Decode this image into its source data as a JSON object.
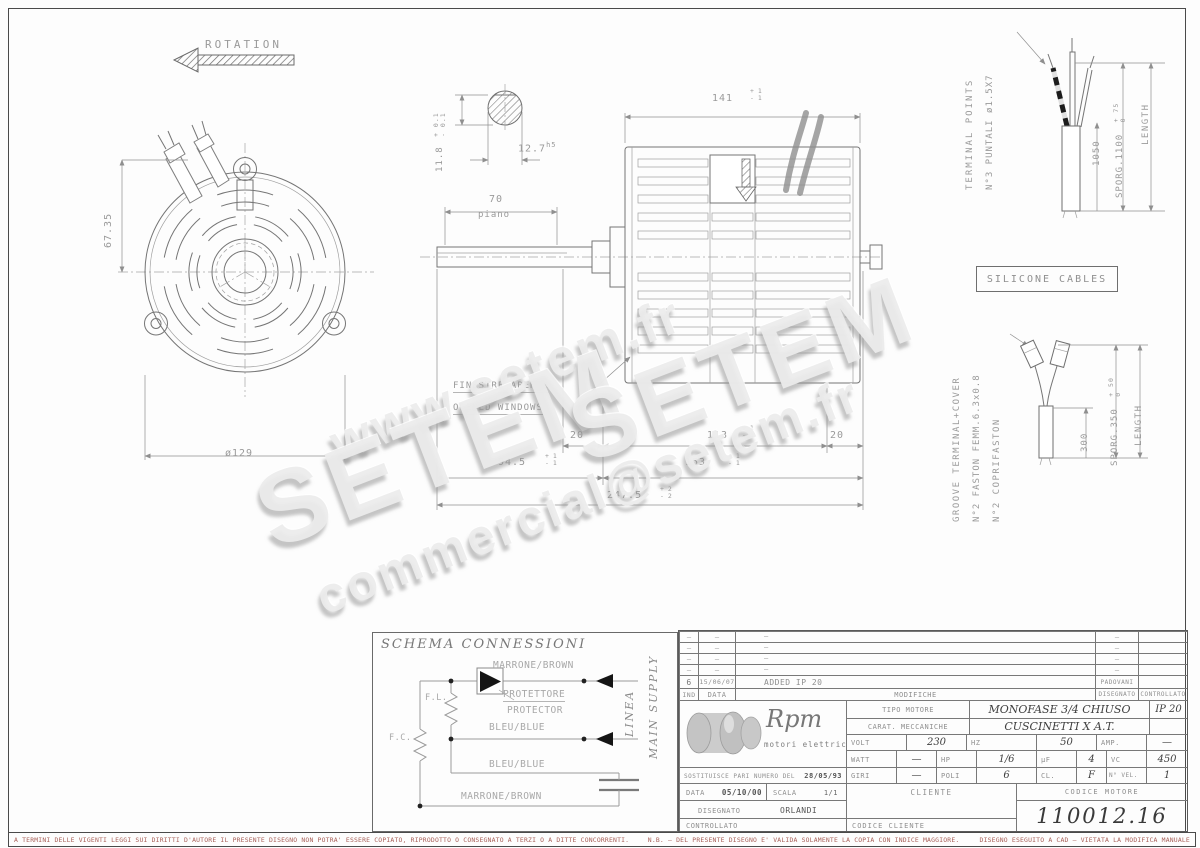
{
  "colors": {
    "disclaimer_red": "#a85f57",
    "cad_line": "#757575",
    "cad_text": "#9a9a9a"
  },
  "watermarks": {
    "w1": "www.setem.fr",
    "w2": "SETEM",
    "w3": "SETEM",
    "w4": "commercial@setem.fr"
  },
  "ann": {
    "rotation": "ROTATION",
    "dim_6735": "67.35",
    "dim_129": "ø129",
    "dim_118": "11.8",
    "tol_01p": "+ 0.1",
    "tol_01m": "- 0.1",
    "dim_127": "12.7",
    "dim_127_fit": "h5",
    "dim_70": "70",
    "piano": "piano",
    "dim_141": "141",
    "tol_1p": "+ 1",
    "tol_1m": "- 1",
    "finestre": "FINESTRE APERTE",
    "opened": "OPENED WINDOWS",
    "dim_20a": "20",
    "dim_113": "113",
    "tol113p": "+ 1",
    "tol113m": "- 1",
    "dim_20b": "20",
    "dim_945": "94.5",
    "tol945p": "+ 1",
    "tol945m": "- 1",
    "dim_153": "153",
    "tol153p": "+ 1",
    "tol153m": "- 1",
    "dim_2475": "247.5",
    "tol_2p": "+ 2",
    "tol_2m": "- 2",
    "terminal_points": "TERMINAL POINTS",
    "puntali": "N°3 PUNTALI ø1.5X7",
    "dim_1050": "1050",
    "sporg_1100": "SPORG.1100",
    "tol_75": "+ 75",
    "tol_0a": "0",
    "length_a": "LENGTH",
    "silicone": "SILICONE CABLES",
    "groove": "GROOVE TERMINAL+COVER",
    "faston": "N°2 FASTON FEMM.6.3x0.8",
    "coprifaston": "N°2 COPRIFASTON",
    "dim_300": "300",
    "sporg_350": "SPORG.350",
    "tol_50": "+ 50",
    "tol_0b": "0",
    "length_b": "LENGTH"
  },
  "schema": {
    "title": "SCHEMA CONNESSIONI",
    "fl": "F.L.",
    "fc": "F.C.",
    "wire_top": "MARRONE/BROWN",
    "protettore": "PROTETTORE",
    "protector": "PROTECTOR",
    "wire_mid": "BLEU/BLUE",
    "wire_low": "BLEU/BLUE",
    "wire_bottom": "MARRONE/BROWN",
    "linea": "LINEA",
    "main_supply": "MAIN SUPPLY"
  },
  "titleblock": {
    "rev_rows": [
      {
        "ind": "–",
        "date": "–",
        "mod": "–",
        "des": "–",
        "ctl": ""
      },
      {
        "ind": "–",
        "date": "–",
        "mod": "–",
        "des": "–",
        "ctl": ""
      },
      {
        "ind": "–",
        "date": "–",
        "mod": "–",
        "des": "–",
        "ctl": ""
      },
      {
        "ind": "–",
        "date": "–",
        "mod": "–",
        "des": "–",
        "ctl": ""
      },
      {
        "ind": "6",
        "date": "15/06/07",
        "mod": "ADDED IP 20",
        "des": "PADOVANI",
        "ctl": ""
      }
    ],
    "headers": {
      "ind": "IND",
      "date": "DATA",
      "mod": "MODIFICHE",
      "des": "DISEGNATO",
      "ctl": "CONTROLLATO"
    },
    "logo": {
      "name": "Rpm",
      "sub": "motori elettrici"
    },
    "tipo_label": "TIPO MOTORE",
    "tipo_value": "MONOFASE 3/4 CHIUSO",
    "ip": "IP 20",
    "carat_label": "CARAT. MECCANICHE",
    "carat_value": "CUSCINETTI X A.T.",
    "volt_row": {
      "l1": "VOLT",
      "v1": "230",
      "l2": "HZ",
      "v2": "50",
      "l3": "AMP.",
      "v3": "—"
    },
    "watt_row": {
      "l1": "WATT",
      "v1": "—",
      "l2": "HP",
      "v2": "1/6",
      "l3": "µF",
      "v3": "4",
      "l4": "VC",
      "v4": "450"
    },
    "giri_row": {
      "l1": "GIRI",
      "v1": "—",
      "l2": "POLI",
      "v2": "6",
      "l3": "CL.",
      "v3": "F",
      "l4": "N° VEL.",
      "v4": "1"
    },
    "sost_label": "SOSTITUISCE PARI NUMERO DEL",
    "sost_value": "28/05/93",
    "data_label": "DATA",
    "data_value": "05/10/00",
    "scala_label": "SCALA",
    "scala_value": "1/1",
    "disegnato_label": "DISEGNATO",
    "disegnato_value": "ORLANDI",
    "controllato_label": "CONTROLLATO",
    "cliente_label": "CLIENTE",
    "codice_motore_label": "CODICE MOTORE",
    "codice_motore_value": "110012.16",
    "codice_cliente_label": "CODICE CLIENTE"
  },
  "footer": {
    "left": "A TERMINI DELLE VIGENTI LEGGI SUI DIRITTI D'AUTORE IL PRESENTE DISEGNO NON POTRA' ESSERE COPIATO, RIPRODOTTO O CONSEGNATO A TERZI O A DITTE CONCORRENTI.",
    "right1": "N.B. – DEL PRESENTE DISEGNO E' VALIDA SOLAMENTE LA COPIA CON INDICE MAGGIORE.",
    "right2": "DISEGNO ESEGUITO A CAD – VIETATA LA MODIFICA MANUALE"
  }
}
